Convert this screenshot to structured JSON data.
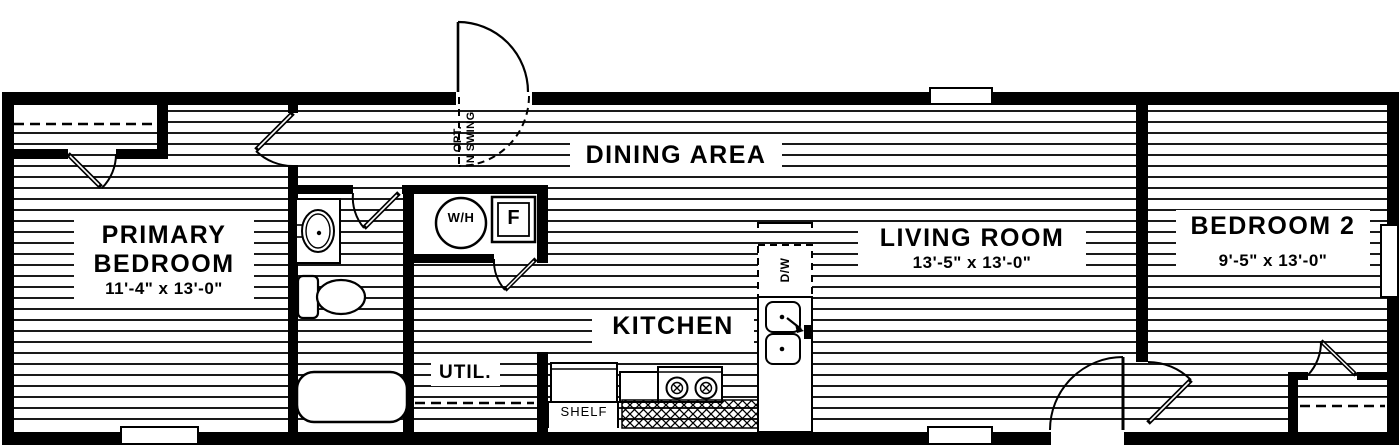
{
  "plan": {
    "rooms": {
      "primary_bedroom": {
        "name_line1": "PRIMARY",
        "name_line2": "BEDROOM",
        "dimensions": "11'-4\" x  13'-0\""
      },
      "dining": {
        "name": "DINING AREA"
      },
      "kitchen": {
        "name": "KITCHEN"
      },
      "living": {
        "name": "LIVING ROOM",
        "dimensions": "13'-5\" x  13'-0\""
      },
      "bedroom2": {
        "name": "BEDROOM 2",
        "dimensions": "9'-5\" x  13'-0\""
      },
      "utility": {
        "name": "UTIL."
      }
    },
    "labels": {
      "shelf": "SHELF",
      "dishwasher": "D/W",
      "water_heater": "W/H",
      "furnace": "F",
      "door_note_line1": "OPT.",
      "door_note_line2": "IN SWING"
    },
    "colors": {
      "wall": "#000000",
      "hatch": "#1a1a1a",
      "background": "#ffffff"
    }
  }
}
